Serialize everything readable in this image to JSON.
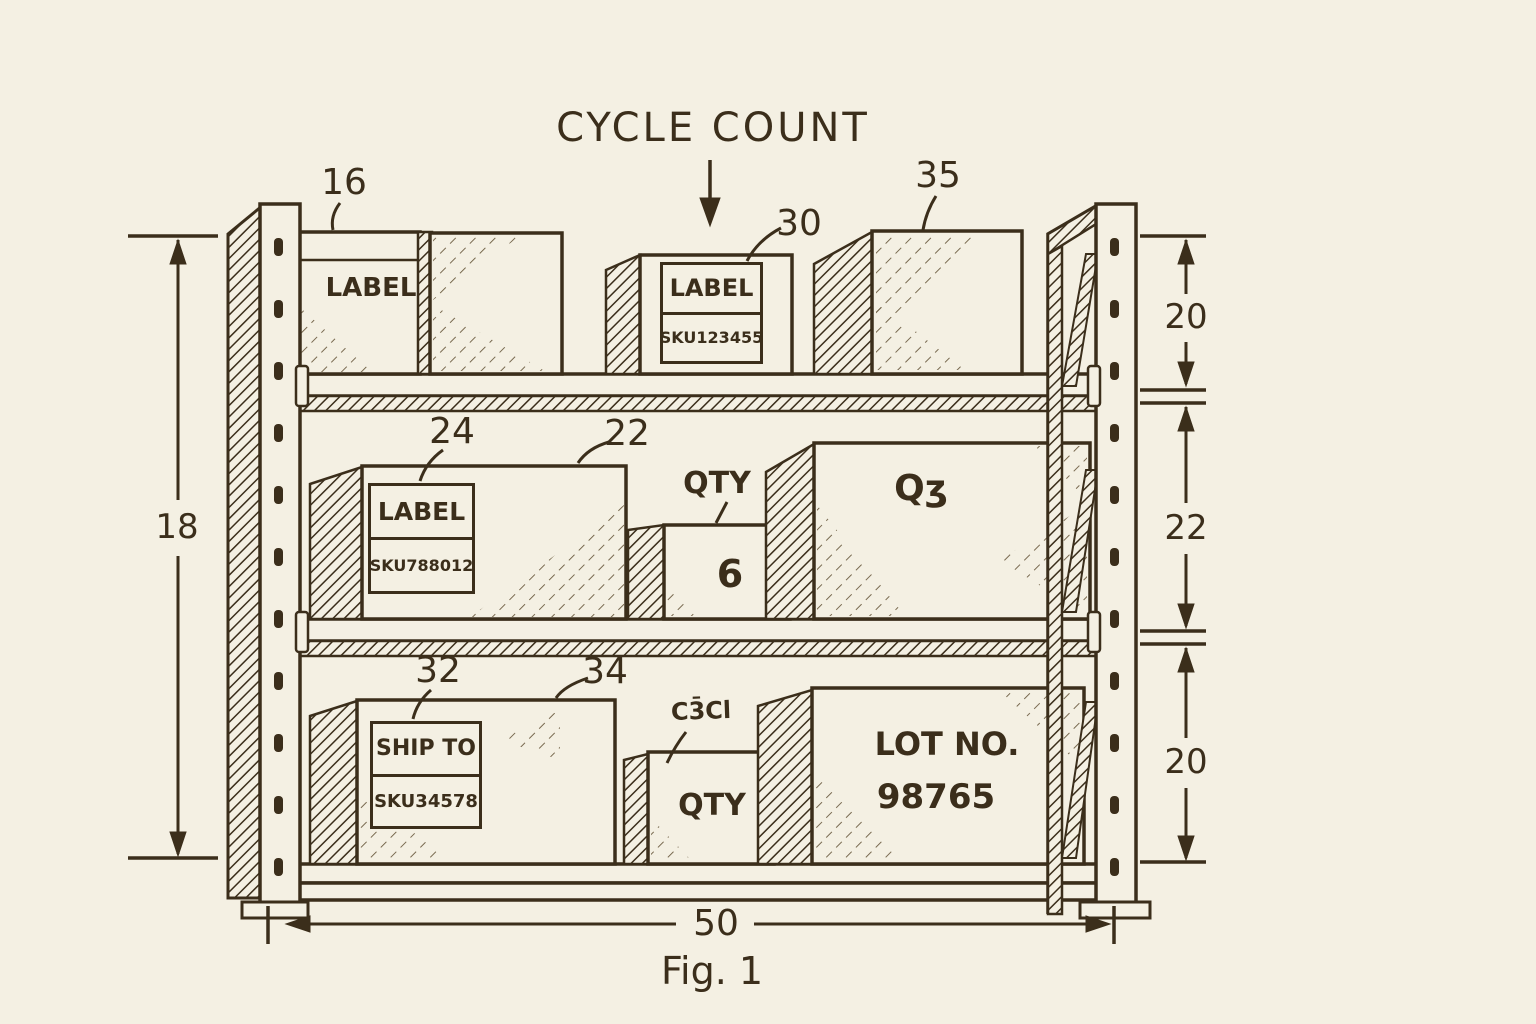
{
  "figure": {
    "title": "CYCLE COUNT",
    "caption": "Fig. 1"
  },
  "dimensions": {
    "overall_height": "18",
    "top_tier": "20",
    "middle_tier": "22",
    "bottom_tier": "20",
    "overall_width": "50"
  },
  "refs": {
    "r16": "16",
    "r30": "30",
    "r35": "35",
    "r24": "24",
    "r22": "22",
    "r32": "32",
    "r34": "34"
  },
  "labels": {
    "top_left_box": "LABEL",
    "top_center_box": {
      "title": "LABEL",
      "sku": "SKU123455"
    },
    "middle_left_box": {
      "title": "LABEL",
      "sku": "SKU788012"
    },
    "middle_qty": {
      "caption": "QTY",
      "value": "6"
    },
    "middle_right_box": "Qʒ",
    "bottom_left_box": {
      "title": "SHIP TO",
      "sku": "SKU34578"
    },
    "bottom_qty": {
      "scribble": "C3̄Cl",
      "caption": "QTY"
    },
    "bottom_right_box": {
      "line1": "LOT NO.",
      "line2": "98765"
    }
  },
  "colors": {
    "ink": "#3b2e1b",
    "paper": "#f4f0e3"
  }
}
